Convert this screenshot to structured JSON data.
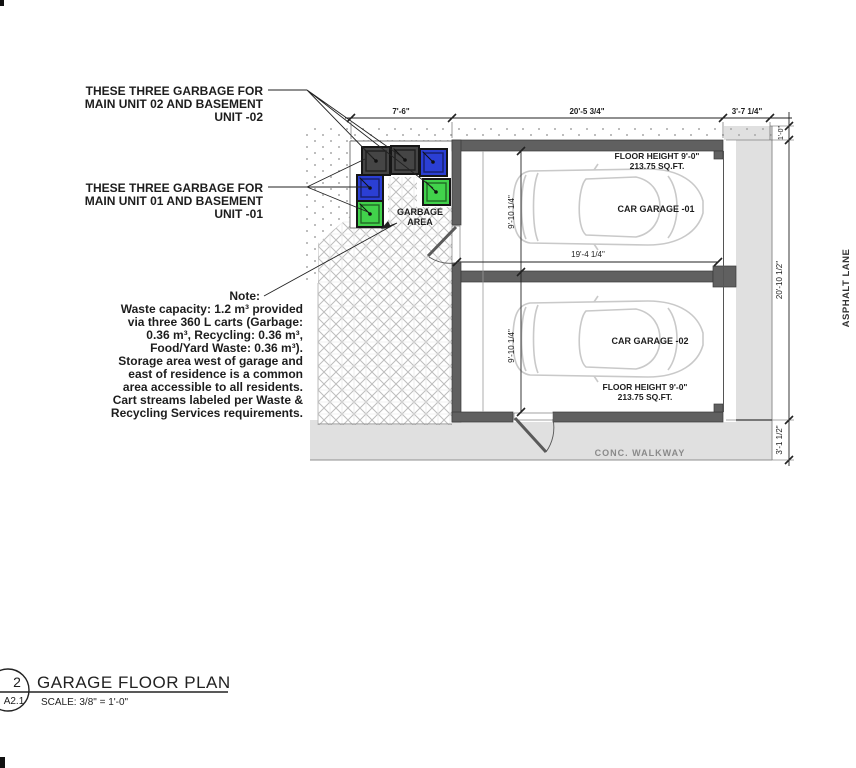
{
  "annotations": {
    "unit02": {
      "lines": [
        "THESE THREE GARBAGE FOR",
        "MAIN UNIT 02 AND BASEMENT",
        "UNIT -02"
      ]
    },
    "unit01": {
      "lines": [
        "THESE THREE GARBAGE FOR",
        "MAIN UNIT 01 AND BASEMENT",
        "UNIT -01"
      ]
    },
    "note": {
      "heading": "Note:",
      "lines": [
        "Waste capacity: 1.2 m³ provided",
        "via three 360 L carts (Garbage:",
        "0.36 m³, Recycling: 0.36 m³,",
        "Food/Yard Waste: 0.36 m³).",
        "Storage area west of garage and",
        "east of residence is a common",
        "area accessible to all residents.",
        "Cart streams labeled per Waste &",
        "Recycling Services requirements."
      ]
    }
  },
  "plan": {
    "garbage_area_label": {
      "line1": "GARBAGE",
      "line2": "AREA"
    },
    "garage01": {
      "floor_height": "FLOOR HEIGHT 9'-0\"",
      "area": "213.75 SQ.FT.",
      "name": "CAR GARAGE -01"
    },
    "garage02": {
      "floor_height": "FLOOR HEIGHT 9'-0\"",
      "area": "213.75 SQ.FT.",
      "name": "CAR GARAGE -02"
    },
    "labels": {
      "asphalt_lane": "ASPHALT LANE",
      "conc_walkway": "CONC. WALKWAY"
    }
  },
  "dimensions": {
    "top": [
      "7'-6\"",
      "20'-5 3/4\"",
      "3'-7 1/4\""
    ],
    "right": [
      "1'-0\"",
      "20'-10 1/2\"",
      "3'-1 1/2\""
    ],
    "garage_width": "19'-4 1/4\"",
    "bay1_depth": "9'-10 1/4\"",
    "bay2_depth": "9'-10 1/4\""
  },
  "title_block": {
    "detail_number": "2",
    "sheet_number": "A2.1",
    "title": "GARAGE FLOOR PLAN",
    "scale": "SCALE:  3/8\" = 1'-0\""
  },
  "colors": {
    "garbage_cart": "#454545",
    "recycling_cart": "#2b3fd4",
    "organics_cart": "#41d24b",
    "wall": "#606060",
    "paving": "#e0e0e0",
    "car_outline": "#c9c9c9"
  }
}
